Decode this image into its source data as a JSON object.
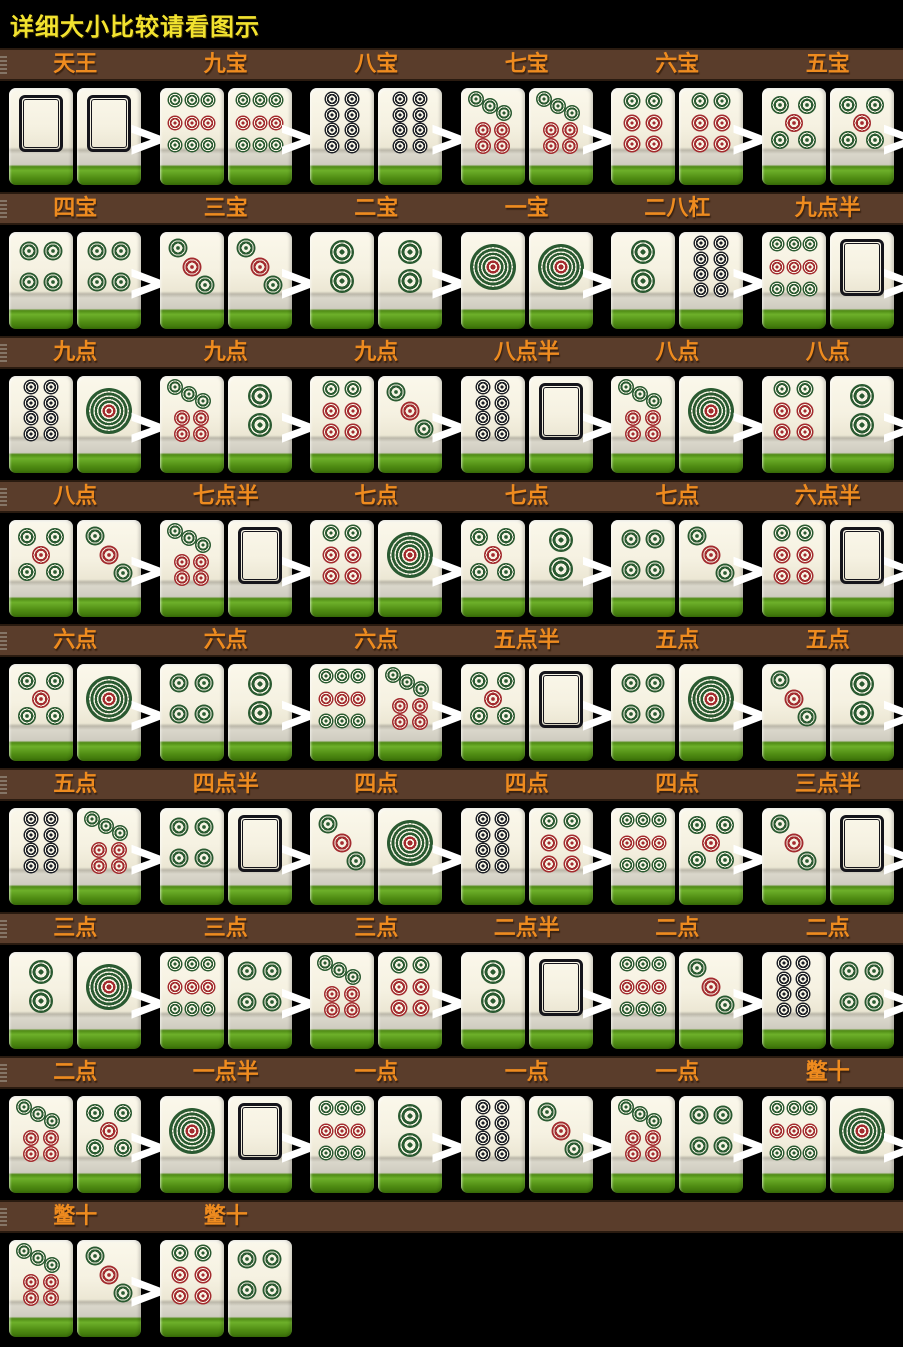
{
  "title": "详细大小比较请看图示",
  "separator": ">",
  "colors": {
    "background": "#000000",
    "header_bar": "#5a3d2b",
    "header_border": "#2a1b10",
    "header_text": "#ee8b1f",
    "title_text": "#f2e22f",
    "separator": "#ffffff",
    "tile_face": "#f5f2e3",
    "dot_green": "#2a5a31",
    "dot_red": "#a32b2f",
    "dot_black": "#1d2027"
  },
  "tile_types": {
    "1": "dot-1",
    "2": "dot-2",
    "3": "dot-3",
    "4": "dot-4",
    "5": "dot-5",
    "6": "dot-6",
    "7": "dot-7",
    "8": "dot-8",
    "9": "dot-9",
    "B": "blank"
  },
  "rows": [
    {
      "cells": [
        {
          "label": "天王",
          "tiles": [
            "B",
            "B"
          ]
        },
        {
          "label": "九宝",
          "tiles": [
            "9",
            "9"
          ]
        },
        {
          "label": "八宝",
          "tiles": [
            "8",
            "8"
          ]
        },
        {
          "label": "七宝",
          "tiles": [
            "7",
            "7"
          ]
        },
        {
          "label": "六宝",
          "tiles": [
            "6",
            "6"
          ]
        },
        {
          "label": "五宝",
          "tiles": [
            "5",
            "5"
          ]
        }
      ]
    },
    {
      "cells": [
        {
          "label": "四宝",
          "tiles": [
            "4",
            "4"
          ]
        },
        {
          "label": "三宝",
          "tiles": [
            "3",
            "3"
          ]
        },
        {
          "label": "二宝",
          "tiles": [
            "2",
            "2"
          ]
        },
        {
          "label": "一宝",
          "tiles": [
            "1",
            "1"
          ]
        },
        {
          "label": "二八杠",
          "tiles": [
            "2",
            "8"
          ]
        },
        {
          "label": "九点半",
          "tiles": [
            "9",
            "B"
          ]
        }
      ]
    },
    {
      "cells": [
        {
          "label": "九点",
          "tiles": [
            "8",
            "1"
          ]
        },
        {
          "label": "九点",
          "tiles": [
            "7",
            "2"
          ]
        },
        {
          "label": "九点",
          "tiles": [
            "6",
            "3"
          ]
        },
        {
          "label": "八点半",
          "tiles": [
            "8",
            "B"
          ]
        },
        {
          "label": "八点",
          "tiles": [
            "7",
            "1"
          ]
        },
        {
          "label": "八点",
          "tiles": [
            "6",
            "2"
          ]
        }
      ]
    },
    {
      "cells": [
        {
          "label": "八点",
          "tiles": [
            "5",
            "3"
          ]
        },
        {
          "label": "七点半",
          "tiles": [
            "7",
            "B"
          ]
        },
        {
          "label": "七点",
          "tiles": [
            "6",
            "1"
          ]
        },
        {
          "label": "七点",
          "tiles": [
            "5",
            "2"
          ]
        },
        {
          "label": "七点",
          "tiles": [
            "4",
            "3"
          ]
        },
        {
          "label": "六点半",
          "tiles": [
            "6",
            "B"
          ]
        }
      ]
    },
    {
      "cells": [
        {
          "label": "六点",
          "tiles": [
            "5",
            "1"
          ]
        },
        {
          "label": "六点",
          "tiles": [
            "4",
            "2"
          ]
        },
        {
          "label": "六点",
          "tiles": [
            "9",
            "7"
          ]
        },
        {
          "label": "五点半",
          "tiles": [
            "5",
            "B"
          ]
        },
        {
          "label": "五点",
          "tiles": [
            "4",
            "1"
          ]
        },
        {
          "label": "五点",
          "tiles": [
            "3",
            "2"
          ]
        }
      ]
    },
    {
      "cells": [
        {
          "label": "五点",
          "tiles": [
            "8",
            "7"
          ]
        },
        {
          "label": "四点半",
          "tiles": [
            "4",
            "B"
          ]
        },
        {
          "label": "四点",
          "tiles": [
            "3",
            "1"
          ]
        },
        {
          "label": "四点",
          "tiles": [
            "8",
            "6"
          ]
        },
        {
          "label": "四点",
          "tiles": [
            "9",
            "5"
          ]
        },
        {
          "label": "三点半",
          "tiles": [
            "3",
            "B"
          ]
        }
      ]
    },
    {
      "cells": [
        {
          "label": "三点",
          "tiles": [
            "2",
            "1"
          ]
        },
        {
          "label": "三点",
          "tiles": [
            "9",
            "4"
          ]
        },
        {
          "label": "三点",
          "tiles": [
            "7",
            "6"
          ]
        },
        {
          "label": "二点半",
          "tiles": [
            "2",
            "B"
          ]
        },
        {
          "label": "二点",
          "tiles": [
            "9",
            "3"
          ]
        },
        {
          "label": "二点",
          "tiles": [
            "8",
            "4"
          ]
        }
      ]
    },
    {
      "cells": [
        {
          "label": "二点",
          "tiles": [
            "7",
            "5"
          ]
        },
        {
          "label": "一点半",
          "tiles": [
            "1",
            "B"
          ]
        },
        {
          "label": "一点",
          "tiles": [
            "9",
            "2"
          ]
        },
        {
          "label": "一点",
          "tiles": [
            "8",
            "3"
          ]
        },
        {
          "label": "一点",
          "tiles": [
            "7",
            "4"
          ]
        },
        {
          "label": "鳖十",
          "tiles": [
            "9",
            "1"
          ]
        }
      ]
    },
    {
      "cells": [
        {
          "label": "鳖十",
          "tiles": [
            "7",
            "3"
          ]
        },
        {
          "label": "鳖十",
          "tiles": [
            "6",
            "4"
          ]
        }
      ]
    }
  ]
}
